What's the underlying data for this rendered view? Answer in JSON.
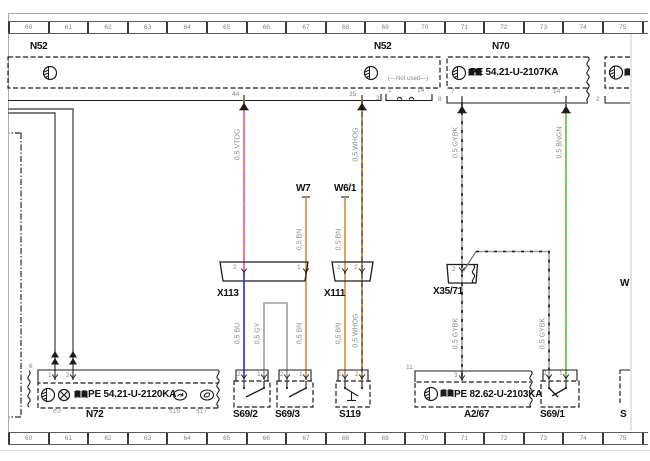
{
  "colors": {
    "vtog": "#e23de2",
    "whbase": "#4d4d4d",
    "gybase": "#9f9f9f",
    "bngn": "#35d435",
    "stripeO": "#f08a1d",
    "stripeK": "#1c1c1c",
    "bn": "#e0883a",
    "bu": "#2a2ae6",
    "gy": "#9f9f9f"
  },
  "ruler": {
    "labels": [
      "60",
      "61",
      "62",
      "63",
      "64",
      "65",
      "66",
      "67",
      "68",
      "69",
      "70",
      "71",
      "72",
      "73",
      "74",
      "75",
      "76"
    ]
  },
  "top": {
    "n52_left": "N52",
    "n52_right": "N52",
    "n70": "N70",
    "n70_pe": "PE  54.21-U-2107KA",
    "pin44": "44",
    "pin35": "35",
    "n52_conn": "3",
    "not_used": "(—Not used—)",
    "nu_pin1": "1",
    "nu_pin14": "14",
    "n70_conn": "8",
    "n70_pin7": "7",
    "n70_pin14": "14",
    "right_conn": "2"
  },
  "middle": {
    "w7": "W7",
    "w61": "W6/1",
    "x113": "X113",
    "x111": "X111",
    "x3571": "X35/71",
    "x113_pin2": "2",
    "x113_pin1": "1",
    "x111_pin1": "1",
    "x111_pin2": "2",
    "x3571_pin2": "2",
    "w_partial": "W"
  },
  "wire_labels": {
    "vtog": "0,5 VTOG",
    "whog_top": "0,5 WHOG",
    "gybk_top": "0,5 GYBK",
    "bngn": "0,5 BNGN",
    "bn_w7": "0,5 BN",
    "bn_w61": "0,5 BN",
    "bu": "0,5 BU",
    "gy": "0,5 GY",
    "bn_s693": "0,5 BN",
    "bn_s119": "0,5 BN",
    "whog_bot": "0,5 WHOG",
    "gybk_a267": "0,5 GYBK",
    "gybk_s691": "0,5 GYBK"
  },
  "bottom": {
    "n72_conn": "6",
    "n72_pin1": "1",
    "n72_pin2": "2",
    "n72_pe": "PE  54.21-U-2120KA",
    "n72": "N72",
    "e3": "e3",
    "s16": "s16",
    "s17": "s17",
    "s692": "S69/2",
    "s692_pin2": "2",
    "s692_pin1": "1",
    "s693": "S69/3",
    "s693_pin2": "2",
    "s693_pin1": "1",
    "s119": "S119",
    "s119_pin1": "1",
    "s119_pin2": "2",
    "a267": "A2/67",
    "a267_conn": "11",
    "a267_pin3": "3",
    "a267_pe": "PE  82.62-U-2103KA",
    "s691": "S69/1",
    "s691_pin2": "2",
    "s691_pin1": "1",
    "s_partial": "S"
  }
}
